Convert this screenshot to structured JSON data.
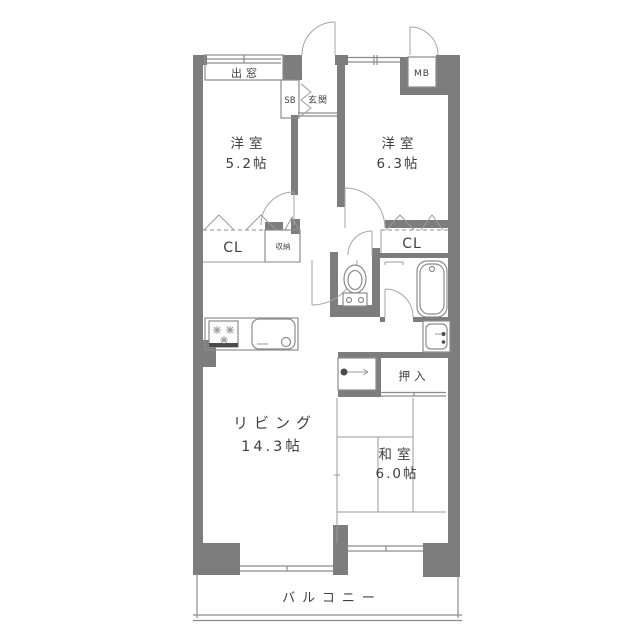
{
  "labels": {
    "bay_window": "出窓",
    "shoe_box": "SB",
    "entrance": "玄関",
    "meter_box": "MB",
    "bedroom_left_name": "洋室",
    "bedroom_left_size": "5.2帖",
    "bedroom_right_name": "洋室",
    "bedroom_right_size": "6.3帖",
    "closet_left": "CL",
    "storage": "収納",
    "closet_right": "CL",
    "oshiire": "押入",
    "living_name": "リビング",
    "living_size": "14.3帖",
    "japanese_room_name": "和室",
    "japanese_room_size": "6.0帖",
    "balcony": "バルコニー"
  },
  "colors": {
    "wall": "#7d7d7d",
    "thin_line": "#8c8c8c",
    "arc_line": "#a5a5a5",
    "text": "#3f3f3f",
    "background": "#ffffff"
  },
  "fixtures": [
    "toilet",
    "bathtub",
    "kitchen-stove",
    "kitchen-sink",
    "washbasin",
    "bay-window",
    "meter-box",
    "shoe-box"
  ]
}
